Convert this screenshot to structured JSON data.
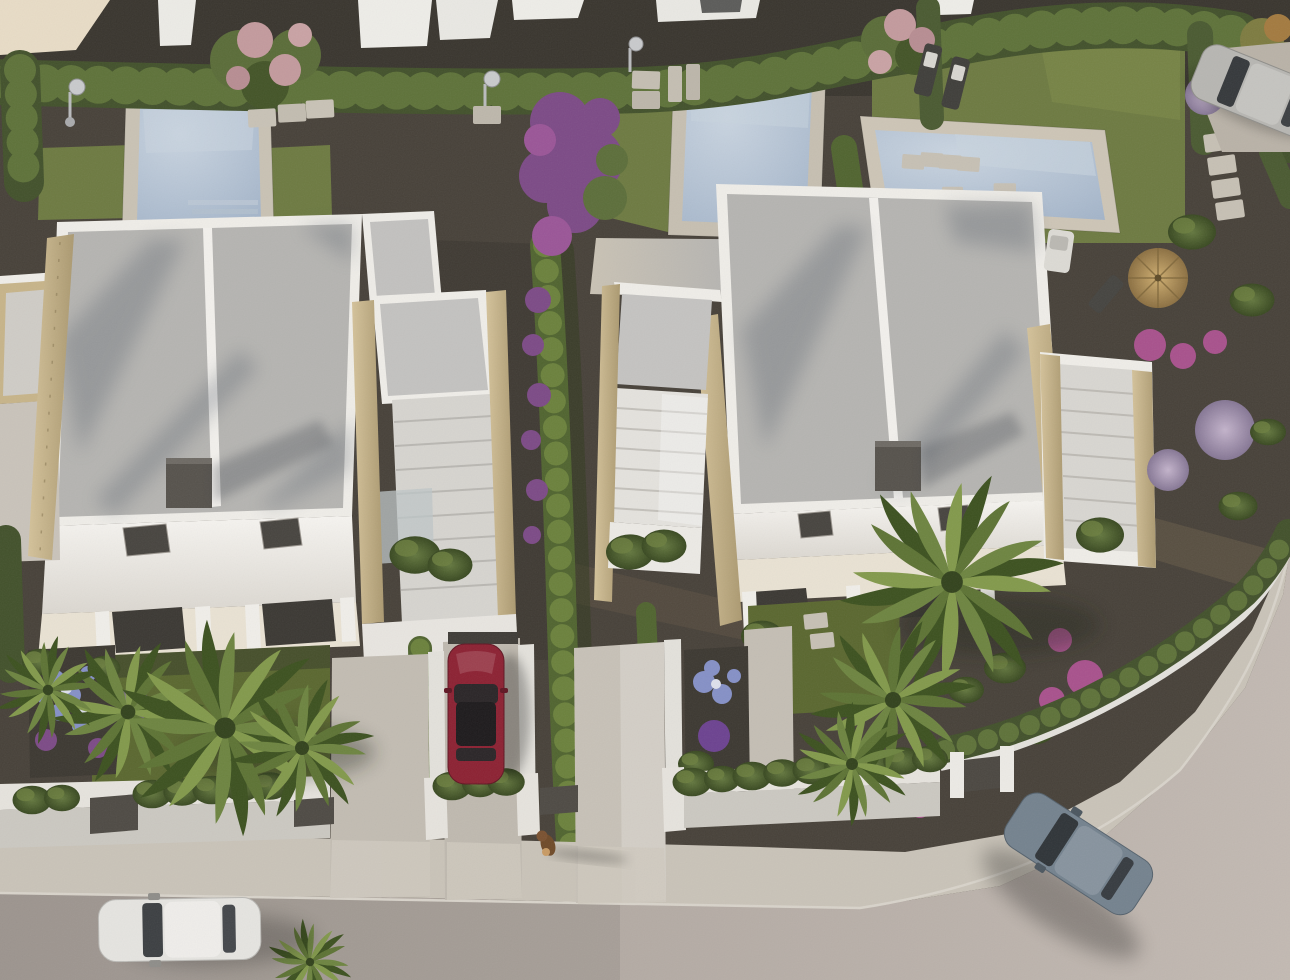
{
  "scene": {
    "type": "aerial-3d-architectural-render",
    "description": "Bird's-eye view of a modern residential development: two white flat-roofed villas with gravel roofs and travertine side walls, three private swimming pools, lawned and gravelled gardens with palms, cypress hedges and bougainvillea, white boundary walls with planter hedges, and a curved street with cars and a small dog on the pavement",
    "lighting": "low warm sun from the west, long shadows cast to the east"
  },
  "palette": {
    "gravel": "#474139",
    "gravelTop": "#39352e",
    "alleyShade": "#2c2a25",
    "grass": "#6d7a41",
    "grassFront": "#5a672f",
    "hedge": "#42512b",
    "hedgeLight": "#5e7239",
    "cypress": "#50642f",
    "roofGravel": "#b5b4b1",
    "white": "#efede8",
    "cream": "#e8dcc6",
    "stone": "#c7b489",
    "deck": "#c9c2b4",
    "deckShade": "#b0b2b5",
    "water": "#a8b8cc",
    "waterLight": "#c8d3de",
    "sidewalk": "#c9c3b8",
    "road": "#b3aaa3",
    "wallTop": "#e6e3dd",
    "wallFace": "#cbc8c1",
    "drive": "#c4beb4",
    "chimney": "#56524c",
    "glass": "#d6d4cf",
    "beige": "#e9e2d3",
    "purple": "#7c4a86",
    "magenta": "#a8518c",
    "lilac": "#a392ad",
    "blueFlower": "#8590c6",
    "pinkBlossom": "#c39a9d",
    "palm": "#6d8440",
    "palmDark": "#4a612c",
    "straw": "#b3955f",
    "carWhite": "#e5e4e0",
    "carRed": "#8c2132",
    "carBlue": "#74828e",
    "carSilver": "#b7b6b2",
    "dog": "#6f4a28",
    "shadow": "#30353c"
  },
  "objects": {
    "villas": [
      {
        "label": "left-villa",
        "features": [
          "flat gravel roof in two panels",
          "rooftop chimney box",
          "two skylights",
          "travertine stone side walls",
          "front terrace with dark glazing",
          "side garage with louvred pergola"
        ]
      },
      {
        "label": "right-villa",
        "features": [
          "flat gravel roof in two panels",
          "rooftop chimney box",
          "two skylights",
          "curved travertine stone walls",
          "louvred pergola annexes on both sides",
          "front terrace with dark glazing"
        ]
      }
    ],
    "pools": [
      {
        "label": "left-plot-pool",
        "surround": "pale stone deck"
      },
      {
        "label": "middle-plot-pool",
        "surround": "pale stone deck with walkway"
      },
      {
        "label": "right-plot-pool",
        "surround": "pale stone deck in lawn"
      }
    ],
    "vehicles": [
      {
        "label": "white-hatchback",
        "location": "street, driving",
        "color_key": "carWhite"
      },
      {
        "label": "dark-red-sedan",
        "location": "villa driveway, parked",
        "color_key": "carRed"
      },
      {
        "label": "blue-grey-sedan",
        "location": "street curve, driving",
        "color_key": "carBlue"
      },
      {
        "label": "silver-suv",
        "location": "rear lane, parked",
        "color_key": "carSilver"
      }
    ],
    "animal": {
      "label": "small-brown-dog",
      "location": "pavement, casting long shadow"
    },
    "garden_elements": [
      "palm trees",
      "cypress hedge lines",
      "bougainvillea tree",
      "pink blossom trees",
      "blue hydrangeas",
      "lavender ball shrub",
      "lilac shrubs",
      "sun loungers",
      "white deck chair",
      "straw parasol",
      "outdoor showers",
      "stepping stone paths",
      "planter hedges on boundary walls",
      "entrance gates"
    ]
  }
}
